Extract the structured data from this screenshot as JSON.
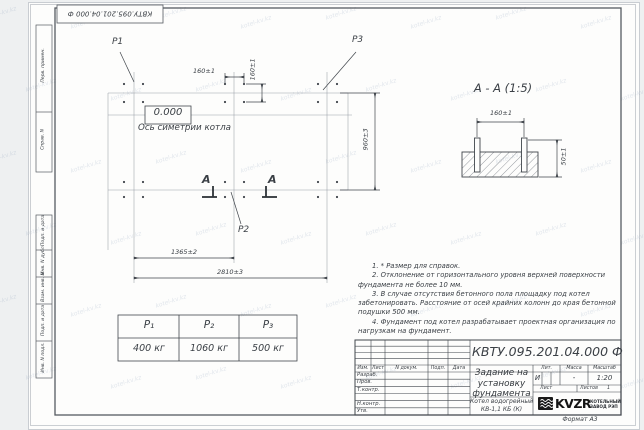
{
  "watermark": {
    "text": "kotel-kv.kz"
  },
  "frame": {
    "top_stamp": "КВТУ.095.201.04.000 Ф",
    "sidebar_top": [
      "Перв. примен.",
      "Справ. N"
    ],
    "sidebar_bottom": [
      "Подп. и дата",
      "Инв. N дубл.",
      "Взам. инв. N",
      "Подп. и дата",
      "Инв. N подл."
    ],
    "format_label": "Формат А3"
  },
  "plan": {
    "p1": "P1",
    "p2": "P2",
    "p3": "P3",
    "elevation": "0.000",
    "axis_label": "Ось симетрии котла",
    "section_letter": "А",
    "dims": {
      "bolt_x": "160±1",
      "bolt_y": "160±1",
      "height_total": "960±3",
      "width_inner": "1365±2",
      "width_total": "2810±3"
    }
  },
  "section": {
    "title": "А - А (1:5)",
    "dim_spacing": "160±1",
    "dim_depth": "50±1"
  },
  "loads_table": {
    "headers": [
      "P₁",
      "P₂",
      "P₃"
    ],
    "values": [
      "400 кг",
      "1060 кг",
      "500 кг"
    ]
  },
  "notes": [
    "1. * Размер для справок.",
    "2. Отклонение от горизонтального уровня верхней поверхности фундамента не более 10 мм.",
    "3. В случае отсутствия бетонного пола площадку под котел забетонировать. Расстояние от осей крайних колонн до края бетонной подушки 500 мм.",
    "4. Фундамент под котел разрабатывает проектная организация по нагрузкам на фундамент."
  ],
  "title_block": {
    "designation": "КВТУ.095.201.04.000  Ф",
    "doc_title": "Задание на установку фундамента",
    "product": "Котел водогрейный КВ-1,1 КБ (К)",
    "header_cells": [
      "Изм.",
      "Лист",
      "N докум.",
      "Подп.",
      "Дата"
    ],
    "rows": [
      "Разраб.",
      "Пров.",
      "Т.контр.",
      "",
      "Н.контр.",
      "Утв."
    ],
    "lit_label": "Лит.",
    "mass_label": "Масса",
    "scale_label": "Масштаб",
    "lit": "И",
    "mass": "-",
    "scale": "1:20",
    "sheet_label": "Лист",
    "sheets_label": "Листов",
    "sheets_value": "1",
    "logo_text": "KVZR",
    "company_line1": "КОТЕЛЬНЫЙ",
    "company_line2": "ЗАВОД РЭП"
  }
}
